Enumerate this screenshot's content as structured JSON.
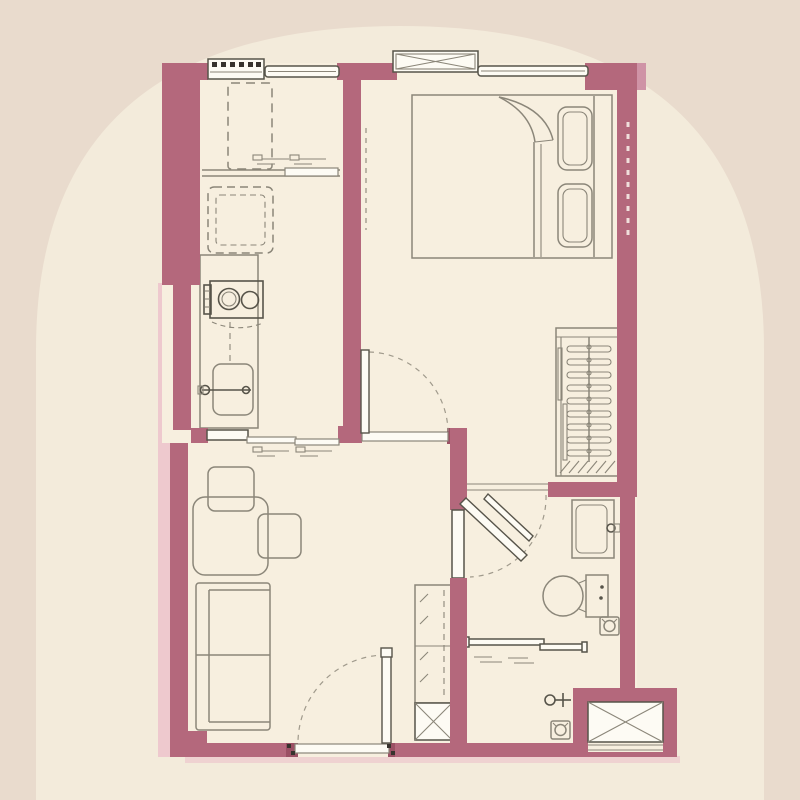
{
  "page": {
    "kind": "floor-plan-drawing",
    "text_labels": []
  },
  "colors": {
    "bg_outer": "#e9dbcd",
    "bg_arch": "#f3ebdb",
    "room_fill": "#f7efdf",
    "wall": "#b4687c",
    "wall_dark": "#9b5064",
    "wall_light": "#cf93a6",
    "pink_glow": "#eec9ce",
    "line": "#8b8679",
    "line_dark": "#57544a",
    "window_fill": "#fdfbf4",
    "ink": "#37322d"
  },
  "plan": {
    "rooms": [
      {
        "name": "kitchen",
        "furniture": [
          "refrigerator-space-dashed",
          "washing-machine-space-dashed",
          "counter",
          "two-burner-stove",
          "kitchen-sink",
          "pass-through-sliding-window"
        ]
      },
      {
        "name": "bedroom",
        "furniture": [
          "double-bed",
          "pillow",
          "pillow",
          "duvet-fold",
          "window",
          "ac-condenser-ledge-box",
          "wardrobe-with-hangers",
          "door-swing"
        ]
      },
      {
        "name": "living-dining",
        "furniture": [
          "dining-table",
          "chair",
          "chair",
          "two-seat-sofa",
          "entrance-door-swing",
          "utility-cabinet",
          "service-shaft"
        ]
      },
      {
        "name": "bathroom",
        "furniture": [
          "door-swing",
          "vanity-sink",
          "toilet",
          "floor-drain",
          "sliding-glass-shower-screen",
          "shower-mixer",
          "floor-drain",
          "ac-ledge-box"
        ]
      }
    ]
  }
}
